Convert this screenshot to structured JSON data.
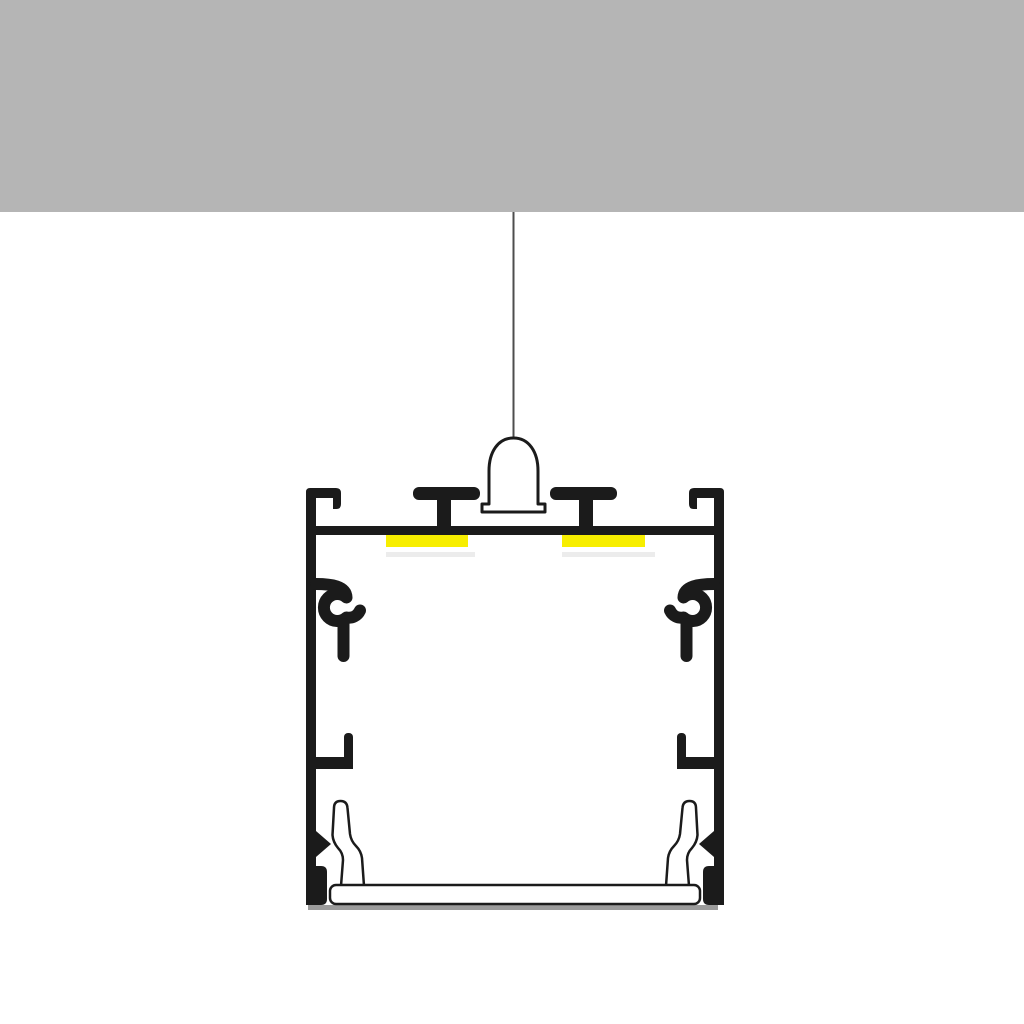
{
  "colors": {
    "background": "#ffffff",
    "ceiling": "#b5b5b5",
    "profile": "#1b1b1b",
    "outline": "#1b1b1b",
    "fixture": "#ffffff",
    "led": "#f7ee00",
    "glow": "#ececec",
    "cable": "#4d4d4d",
    "shadow": "#9b9b9b"
  },
  "components": {
    "ceiling": "ceiling",
    "cable": "suspension-cable",
    "mount": "suspension-mount",
    "housing": "aluminium-profile-housing",
    "led_left": "led-strip-left",
    "led_right": "led-strip-right",
    "clip_left": "side-clip-left",
    "clip_right": "side-clip-right",
    "diffuser": "diffuser-cover",
    "shadow": "drop-shadow"
  }
}
